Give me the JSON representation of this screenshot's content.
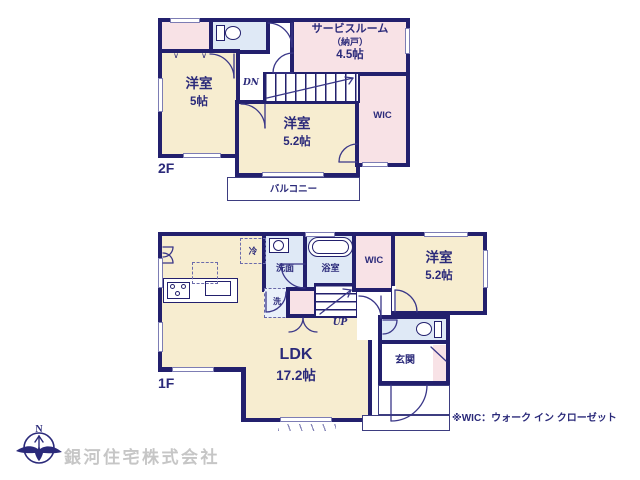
{
  "colors": {
    "wall": "#23206d",
    "ink": "#2b2a7a",
    "cream": "#f7edd0",
    "pink": "#f8e2e6",
    "blue": "#dfe9f6",
    "thin": "#3d3d80",
    "gray_text": "#c6c6c6"
  },
  "floor2": {
    "label": "2F",
    "bedroom_a": {
      "name": "洋室",
      "size": "5帖"
    },
    "bedroom_b": {
      "name": "洋室",
      "size": "5.2帖"
    },
    "service_room": {
      "line1": "サービスルーム",
      "line2": "（納戸）",
      "line3": "4.5帖"
    },
    "wic": "WIC",
    "balcony": "バルコニー",
    "stairs_label": "DN"
  },
  "floor1": {
    "label": "1F",
    "ldk": {
      "name": "LDK",
      "size": "17.2帖"
    },
    "bedroom": {
      "name": "洋室",
      "size": "5.2帖"
    },
    "wic": "WIC",
    "entrance": "玄関",
    "washroom": "洗面",
    "bathroom": "浴室",
    "laundry": "洗",
    "fridge": "冷",
    "stairs_label": "UP"
  },
  "glyphs": {
    "closet_mark": "∨"
  },
  "note": "※WIC：ウォーク イン クローゼット",
  "company": {
    "name": "銀河住宅株式会社",
    "compass": "N"
  }
}
